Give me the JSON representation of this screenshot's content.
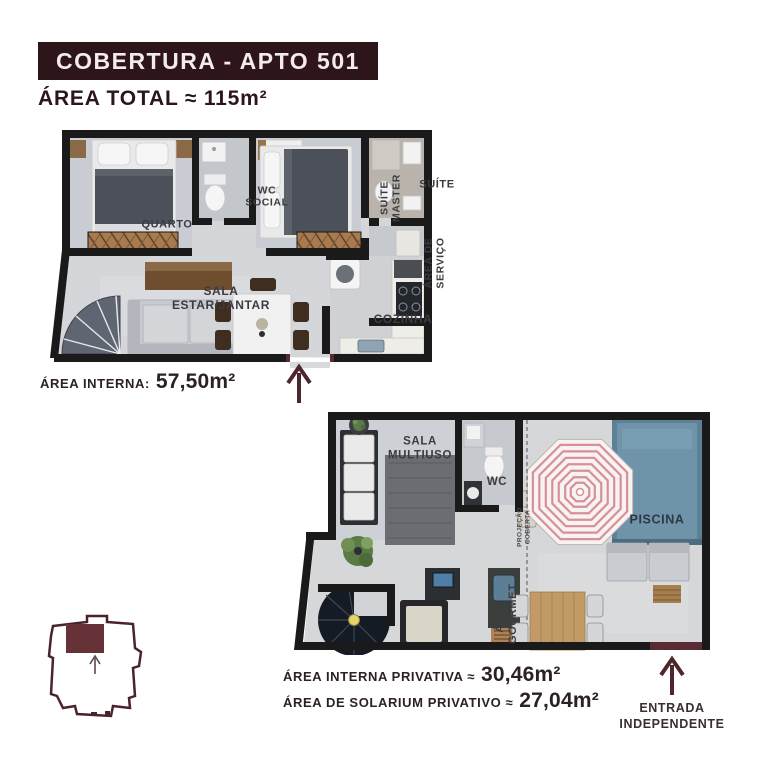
{
  "header": {
    "title": "COBERTURA - APTO 501",
    "area_total": "ÁREA TOTAL ≈ 115m²"
  },
  "upper_plan": {
    "labels": {
      "quarto": "QUARTO",
      "wc_social": "WC SOCIAL",
      "suite_master": "SUÍTE MASTER",
      "suite": "SUÍTE",
      "area_servico": "ÁREA DE SERVIÇO",
      "sala": "SALA ESTAR/JANTAR",
      "cozinha": "COZINHA"
    },
    "area_label": "ÁREA INTERNA:",
    "area_value": "57,50m²"
  },
  "lower_plan": {
    "labels": {
      "sala_multiuso": "SALA MULTIUSO",
      "wc": "WC",
      "piscina": "PISCINA",
      "projecao_coberta": "PROJEÇÃO COBERTA",
      "area_gourmet": "ÁREA GOURMET"
    },
    "stats": {
      "interna_label": "ÁREA INTERNA PRIVATIVA ≈",
      "interna_value": "30,46m²",
      "solarium_label": "ÁREA DE SOLARIUM PRIVATIVO ≈",
      "solarium_value": "27,04m²"
    },
    "entrada": "ENTRADA INDEPENDENTE"
  },
  "colors": {
    "maroon_dark": "#2d151a",
    "maroon_accent": "#5a2b32",
    "arrow": "#4e262d",
    "wall_black": "#1a1a1a",
    "pool_blue": "#6f93a9",
    "umbrella_pink": "#d98f97",
    "stair_yellow": "#e6d468",
    "wood": "#a07648",
    "label_gray": "#3b3b42"
  }
}
